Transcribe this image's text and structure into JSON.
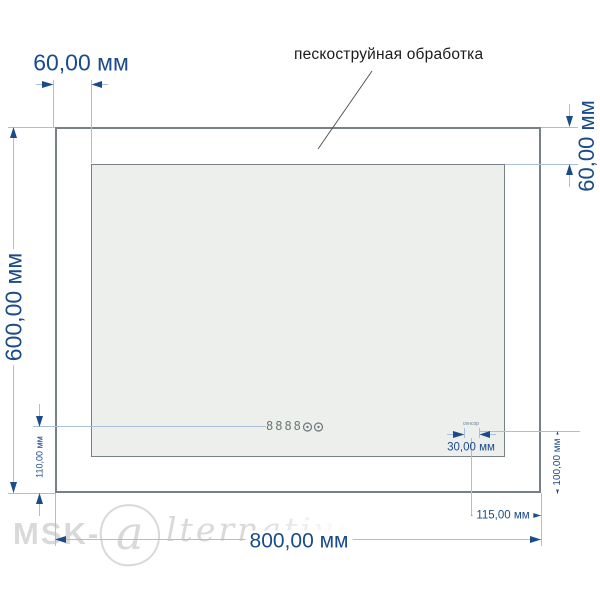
{
  "annotation": {
    "label": "пескоструйная обработка"
  },
  "dimensions": {
    "width": "800,00 мм",
    "height": "600,00 мм",
    "border_top": "60,00 мм",
    "border_right": "60,00 мм"
  },
  "display": {
    "value": "8888",
    "height_label": "110,00 мм"
  },
  "sensor": {
    "label": "сенсор",
    "width_label": "30,00 мм",
    "offset_label": "115,00 мм",
    "height_label": "100,00 мм"
  },
  "watermark": {
    "prefix": "MSK-",
    "logo_letter": "a",
    "script": "lternativa"
  },
  "colors": {
    "dimension_text": "#1b4b8a",
    "dimension_line": "#abc0d6",
    "drawing_border": "#798083",
    "mirror_fill": "#edefec",
    "annotation_text": "#1b1b1b",
    "watermark": "#d9d9d9",
    "display_color": "#6e7678",
    "sensor_label_color": "#6f7f96"
  }
}
